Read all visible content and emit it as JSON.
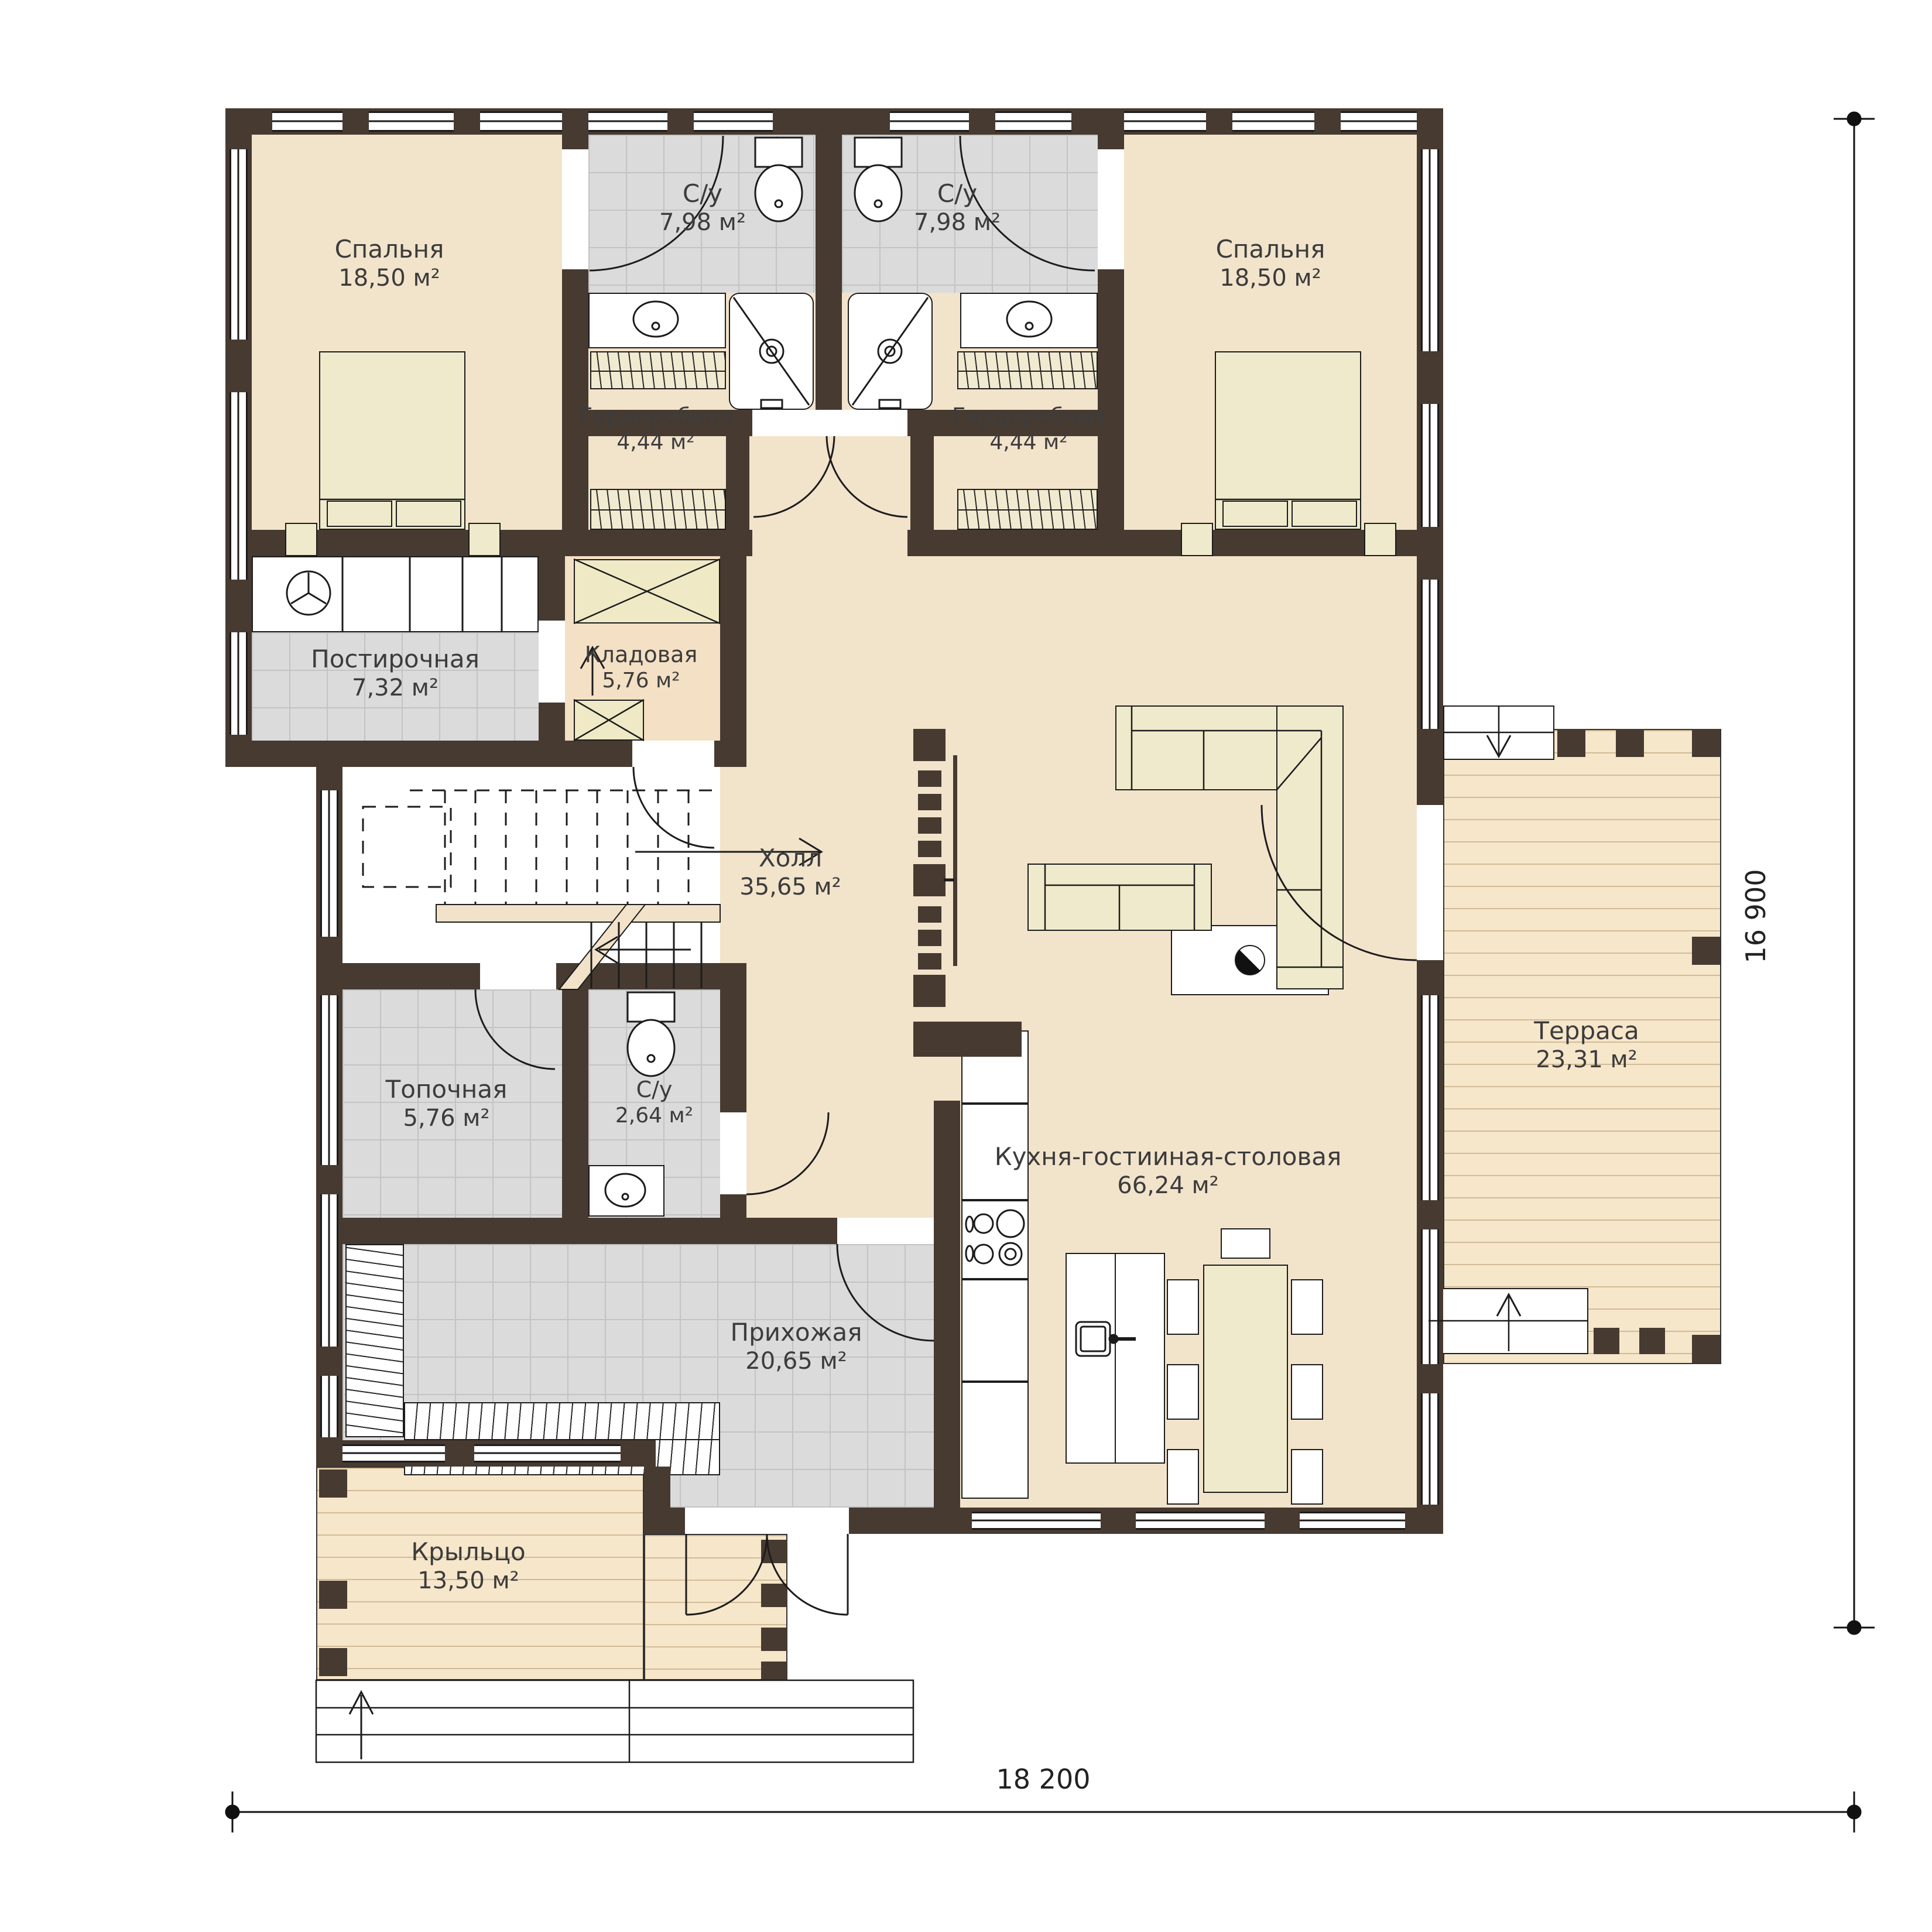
{
  "plan_title": "floor-plan-level-1",
  "rooms": [
    {
      "id": "bedroom-left",
      "label": "Спальня",
      "area": "18,50 м²"
    },
    {
      "id": "bathroom-top-left",
      "label": "С/у",
      "area": "7,98 м²"
    },
    {
      "id": "bathroom-top-right",
      "label": "С/у",
      "area": "7,98 м²"
    },
    {
      "id": "bedroom-right",
      "label": "Спальня",
      "area": "18,50 м²"
    },
    {
      "id": "wardrobe-left",
      "label": "Гардеробная",
      "area": "4,44 м²"
    },
    {
      "id": "wardrobe-right",
      "label": "Гардеробная",
      "area": "4,44 м²"
    },
    {
      "id": "laundry",
      "label": "Постирочная",
      "area": "7,32 м²"
    },
    {
      "id": "storage",
      "label": "Кладовая",
      "area": "5,76 м²"
    },
    {
      "id": "hall",
      "label": "Холл",
      "area": "35,65 м²"
    },
    {
      "id": "boiler-room",
      "label": "Топочная",
      "area": "5,76 м²"
    },
    {
      "id": "bathroom-small",
      "label": "С/у",
      "area": "2,64 м²"
    },
    {
      "id": "kitchen-living-dining",
      "label": "Кухня-гостииная-столовая",
      "area": "66,24 м²"
    },
    {
      "id": "terrace",
      "label": "Терраса",
      "area": "23,31 м²"
    },
    {
      "id": "entry-hall",
      "label": "Прихожая",
      "area": "20,65 м²"
    },
    {
      "id": "porch",
      "label": "Крыльцо",
      "area": "13,50 м²"
    }
  ],
  "dimensions": {
    "width_label": "18 200",
    "height_label": "16 900"
  },
  "colors": {
    "wall": "#473a31",
    "floor_beige": "#f2e3cb",
    "floor_tile": "#dbdbdb",
    "deck": "#f6e6ca",
    "furniture": "#eeeacb"
  }
}
